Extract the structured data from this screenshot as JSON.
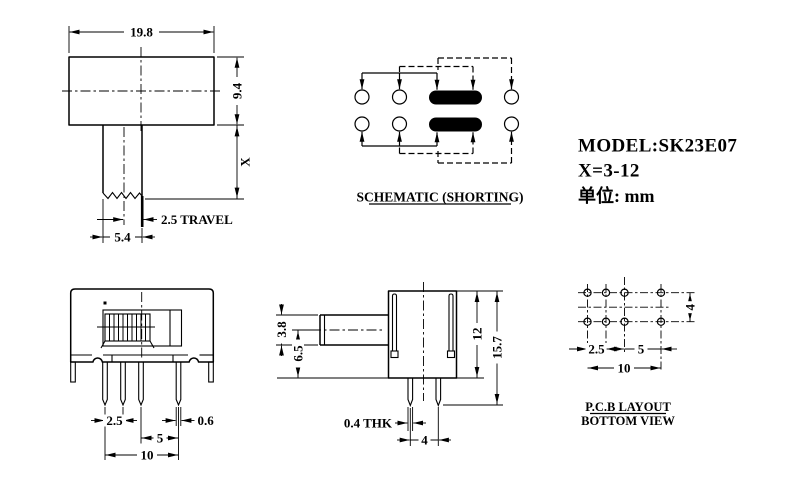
{
  "drawing": {
    "background": "#ffffff",
    "line_color": "#000000",
    "title_block": {
      "model": "MODEL:SK23E07",
      "x_range": "X=3-12",
      "unit_label": "单位: mm"
    },
    "top_view": {
      "dims": {
        "width": "19.8",
        "height": "9.4",
        "shaft_len": "X",
        "travel": "2.5 TRAVEL",
        "shaft_width": "5.4"
      }
    },
    "schematic": {
      "caption": "SCHEMATIC (SHORTING)"
    },
    "front_view": {
      "dims": {
        "pitch_small": "2.5",
        "pitch_large": "5",
        "span": "10",
        "pin_width": "0.6"
      }
    },
    "side_view": {
      "dims": {
        "knob_height": "3.8",
        "knob_center": "6.5",
        "body_height": "12",
        "total_height": "15.7",
        "pin_thickness": "0.4 THK",
        "pin_spacing": "4"
      }
    },
    "pcb_view": {
      "caption_line1": "P.C.B LAYOUT",
      "caption_line2": "BOTTOM VIEW",
      "dims": {
        "pitch_small": "2.5",
        "pitch_large": "5",
        "span": "10",
        "row_spacing": "4"
      }
    }
  }
}
